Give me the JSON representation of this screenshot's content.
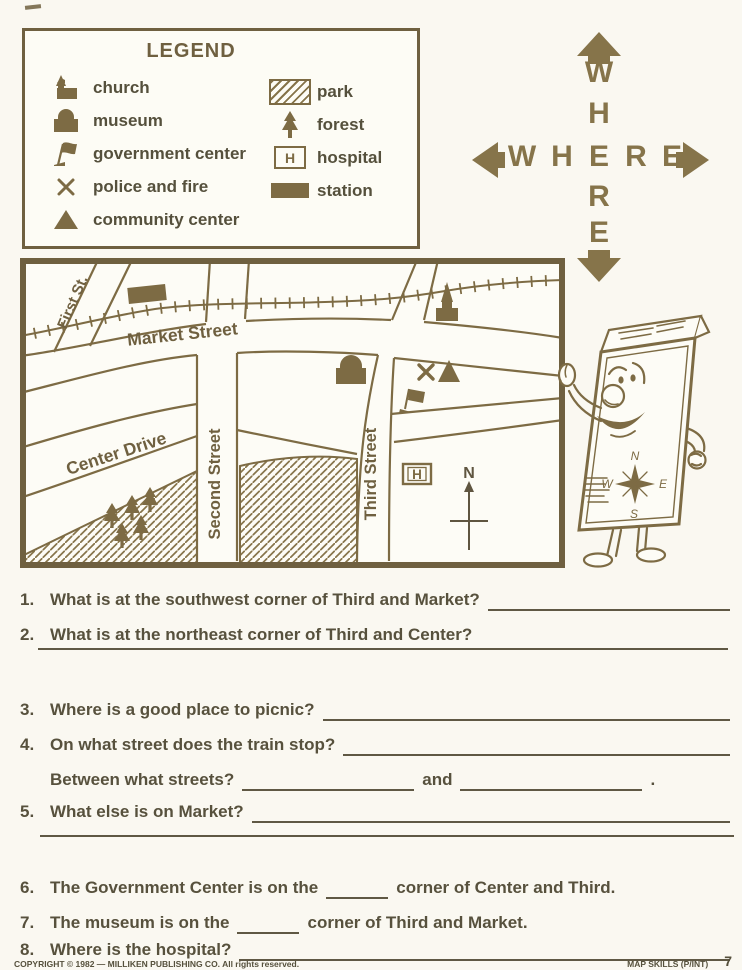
{
  "page": {
    "background": "#faf8f1",
    "ink": "#7d6b44",
    "text_color": "#57513d"
  },
  "legend": {
    "title": "LEGEND",
    "left_items": [
      {
        "icon": "church-icon",
        "label": "church"
      },
      {
        "icon": "museum-icon",
        "label": "museum"
      },
      {
        "icon": "government-flag-icon",
        "label": "government center"
      },
      {
        "icon": "police-fire-x-icon",
        "label": "police and fire"
      },
      {
        "icon": "community-center-triangle-icon",
        "label": "community center"
      }
    ],
    "right_items": [
      {
        "icon": "park-hatch-icon",
        "label": "park"
      },
      {
        "icon": "forest-tree-icon",
        "label": "forest"
      },
      {
        "icon": "hospital-box-icon",
        "label": "hospital",
        "symbol": "H"
      },
      {
        "icon": "station-block-icon",
        "label": "station"
      }
    ]
  },
  "where_graphic": {
    "letters": [
      "W",
      "H",
      "E",
      "R",
      "E"
    ]
  },
  "map": {
    "labels": {
      "first": "First St.",
      "market": "Market Street",
      "second": "Second Street",
      "third": "Third Street",
      "center": "Center Drive"
    },
    "compass_label": "N",
    "hospital_symbol": "H"
  },
  "character": {
    "rose": {
      "n": "N",
      "e": "E",
      "s": "S",
      "w": "W"
    }
  },
  "questions": {
    "q1": {
      "num": "1.",
      "text": "What is at the southwest corner of Third and Market?"
    },
    "q2": {
      "num": "2.",
      "text": "What is at the northeast corner of Third and Center?"
    },
    "q3": {
      "num": "3.",
      "text": "Where is a good place to picnic?"
    },
    "q4": {
      "num": "4.",
      "text": "On what street does the train stop?"
    },
    "q4b": {
      "pre": "Between what streets?",
      "conj": "and",
      "period": "."
    },
    "q5": {
      "num": "5.",
      "text": "What else is on Market?"
    },
    "q6": {
      "num": "6.",
      "pre": "The Government Center is on the",
      "post": "corner of Center and Third."
    },
    "q7": {
      "num": "7.",
      "pre": "The museum is on the",
      "post": "corner of Third and Market."
    },
    "q8": {
      "num": "8.",
      "text": "Where is the hospital?"
    }
  },
  "footer": {
    "copyright": "COPYRIGHT © 1982 — MILLIKEN PUBLISHING CO. All rights reserved.",
    "series": "MAP SKILLS (P/INT)",
    "page_number": "7"
  }
}
